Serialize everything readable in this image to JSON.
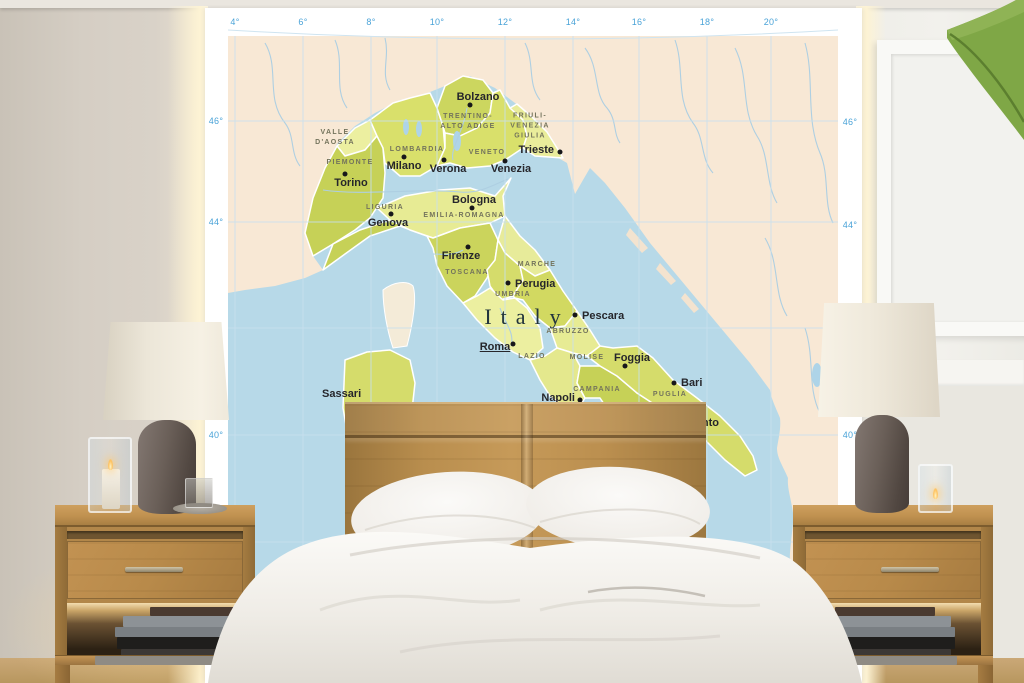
{
  "map": {
    "country_label": "Italy",
    "longitude_labels": [
      "4°",
      "6°",
      "8°",
      "10°",
      "12°",
      "14°",
      "16°",
      "18°",
      "20°"
    ],
    "latitude_labels_left": [
      "46°",
      "44°",
      "40°"
    ],
    "latitude_labels_right": [
      "46°",
      "44°",
      "40°"
    ],
    "cities": [
      "Bolzano",
      "Trieste",
      "Milano",
      "Verona",
      "Venezia",
      "Torino",
      "Genova",
      "Bologna",
      "Firenze",
      "Perugia",
      "Pescara",
      "Roma",
      "Foggia",
      "Napoli",
      "Bari",
      "Sassari",
      "Taranto"
    ],
    "regions": [
      "VALLE\nD'AOSTA",
      "TRENTINO-\nALTO ADIGE",
      "FRIULI-\nVENEZIA\nGIULIA",
      "LOMBARDIA",
      "VENETO",
      "PIEMONTE",
      "LIGURIA",
      "EMILIA-ROMAGNA",
      "TOSCANA",
      "MARCHE",
      "UMBRIA",
      "LAZIO",
      "ABRUZZO",
      "MOLISE",
      "CAMPANIA",
      "PUGLIA"
    ],
    "colors": {
      "sea": "#b7d9e8",
      "land_other": "#f8e8d5",
      "region_light": "#ecefa0",
      "region_mid": "#d9e06b",
      "region_dark": "#c6d157",
      "river": "#aecfe2",
      "axis_text": "#4aa3d8",
      "city_text": "#26262b",
      "region_text": "#73735c"
    }
  },
  "room": {
    "colors": {
      "wood_oak": "#b98a4c",
      "wall_left": "#d3ccc2",
      "backlight_glow": "#fdf3d4",
      "bedding_white": "#f2f0ec",
      "lamp_base_taupe": "#6a5f58",
      "lamp_shade_cream": "#efe8da",
      "leaf_green": "#7fa746",
      "floor_tan": "#c8a470"
    }
  }
}
